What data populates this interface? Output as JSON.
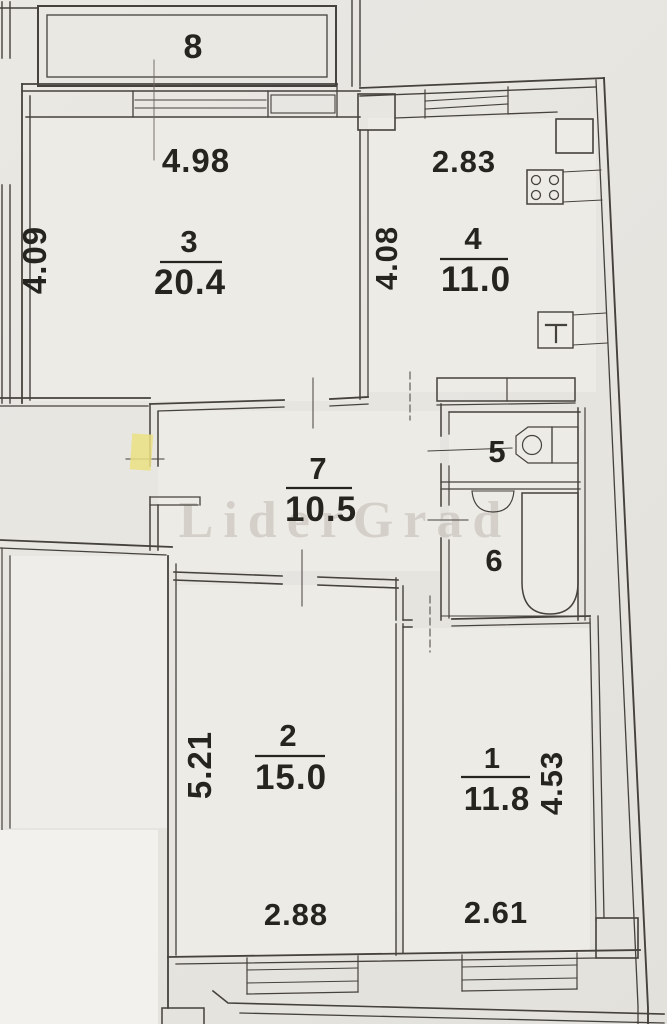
{
  "watermark": "LiderGrad",
  "rooms": {
    "balcony": {
      "number": "8"
    },
    "room3": {
      "number": "3",
      "area": "20.4",
      "width": "4.98",
      "depth": "4.09"
    },
    "room4": {
      "number": "4",
      "area": "11.0",
      "width": "2.83",
      "depth": "4.08"
    },
    "room7": {
      "number": "7",
      "area": "10.5"
    },
    "room5": {
      "number": "5"
    },
    "room6": {
      "number": "6"
    },
    "room2": {
      "number": "2",
      "area": "15.0",
      "depth": "5.21",
      "width": "2.88"
    },
    "room1": {
      "number": "1",
      "area": "11.8",
      "depth": "4.53",
      "width": "2.61"
    }
  }
}
